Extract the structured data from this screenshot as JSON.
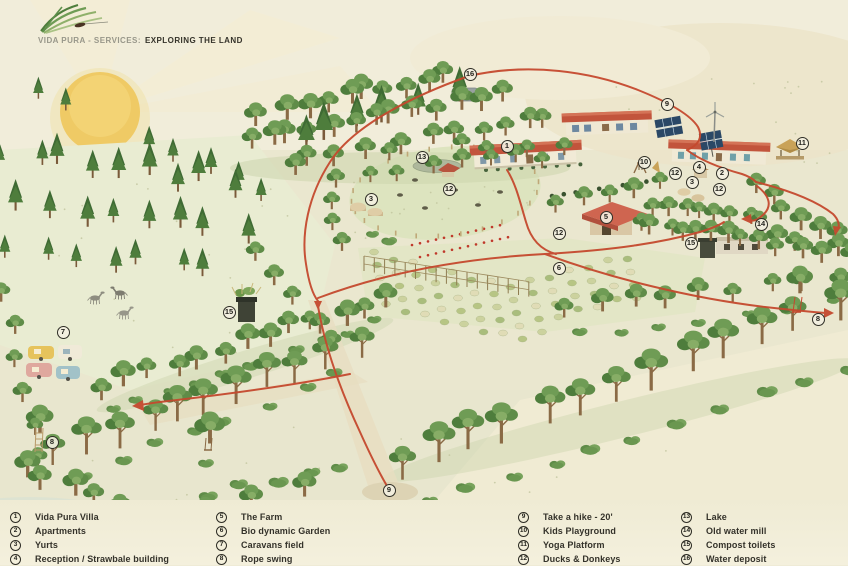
{
  "header": {
    "brand_prefix": "VIDA PURA - SERVICES:",
    "title": "EXPLORING THE LAND"
  },
  "legend": {
    "columns": [
      {
        "items": [
          {
            "num": "1",
            "label": "Vida Pura Villa"
          },
          {
            "num": "2",
            "label": "Apartments"
          },
          {
            "num": "3",
            "label": "Yurts"
          },
          {
            "num": "4",
            "label": "Reception / Strawbale building"
          }
        ]
      },
      {
        "items": [
          {
            "num": "5",
            "label": "The Farm"
          },
          {
            "num": "6",
            "label": "Bio dynamic Garden"
          },
          {
            "num": "7",
            "label": "Caravans field"
          },
          {
            "num": "8",
            "label": "Rope swing"
          }
        ]
      },
      {
        "items": [
          {
            "num": "9",
            "label": "Take a hike - 20'"
          },
          {
            "num": "10",
            "label": "Kids Playground"
          },
          {
            "num": "11",
            "label": "Yoga Platform"
          },
          {
            "num": "12",
            "label": "Ducks & Donkeys"
          }
        ]
      },
      {
        "items": [
          {
            "num": "13",
            "label": "Lake"
          },
          {
            "num": "14",
            "label": "Old water mill"
          },
          {
            "num": "15",
            "label": "Compost toilets"
          },
          {
            "num": "16",
            "label": "Water deposit"
          }
        ]
      }
    ]
  },
  "map": {
    "markers": [
      {
        "num": "16",
        "x": 470,
        "y": 74
      },
      {
        "num": "9",
        "x": 667,
        "y": 104
      },
      {
        "num": "11",
        "x": 802,
        "y": 143
      },
      {
        "num": "1",
        "x": 507,
        "y": 146
      },
      {
        "num": "13",
        "x": 422,
        "y": 157
      },
      {
        "num": "10",
        "x": 644,
        "y": 162
      },
      {
        "num": "4",
        "x": 699,
        "y": 167
      },
      {
        "num": "12",
        "x": 675,
        "y": 173
      },
      {
        "num": "2",
        "x": 722,
        "y": 173
      },
      {
        "num": "3",
        "x": 692,
        "y": 182
      },
      {
        "num": "12",
        "x": 719,
        "y": 189
      },
      {
        "num": "12",
        "x": 449,
        "y": 189
      },
      {
        "num": "3",
        "x": 371,
        "y": 199
      },
      {
        "num": "5",
        "x": 606,
        "y": 217
      },
      {
        "num": "14",
        "x": 761,
        "y": 224
      },
      {
        "num": "12",
        "x": 559,
        "y": 233
      },
      {
        "num": "15",
        "x": 691,
        "y": 243
      },
      {
        "num": "6",
        "x": 559,
        "y": 268
      },
      {
        "num": "15",
        "x": 229,
        "y": 312
      },
      {
        "num": "7",
        "x": 63,
        "y": 332
      },
      {
        "num": "8",
        "x": 818,
        "y": 319
      },
      {
        "num": "8",
        "x": 52,
        "y": 442
      },
      {
        "num": "9",
        "x": 389,
        "y": 490
      }
    ],
    "icons": [
      "sun-icon",
      "wind-turbine-icon",
      "solar-panel-icon",
      "grass-logo-icon"
    ]
  },
  "colors": {
    "paper": "#efebd6",
    "path_red": "#c5492e",
    "tree_green": "#4e7d3c",
    "roof_red": "#c2543c",
    "sun": "#efca65"
  }
}
